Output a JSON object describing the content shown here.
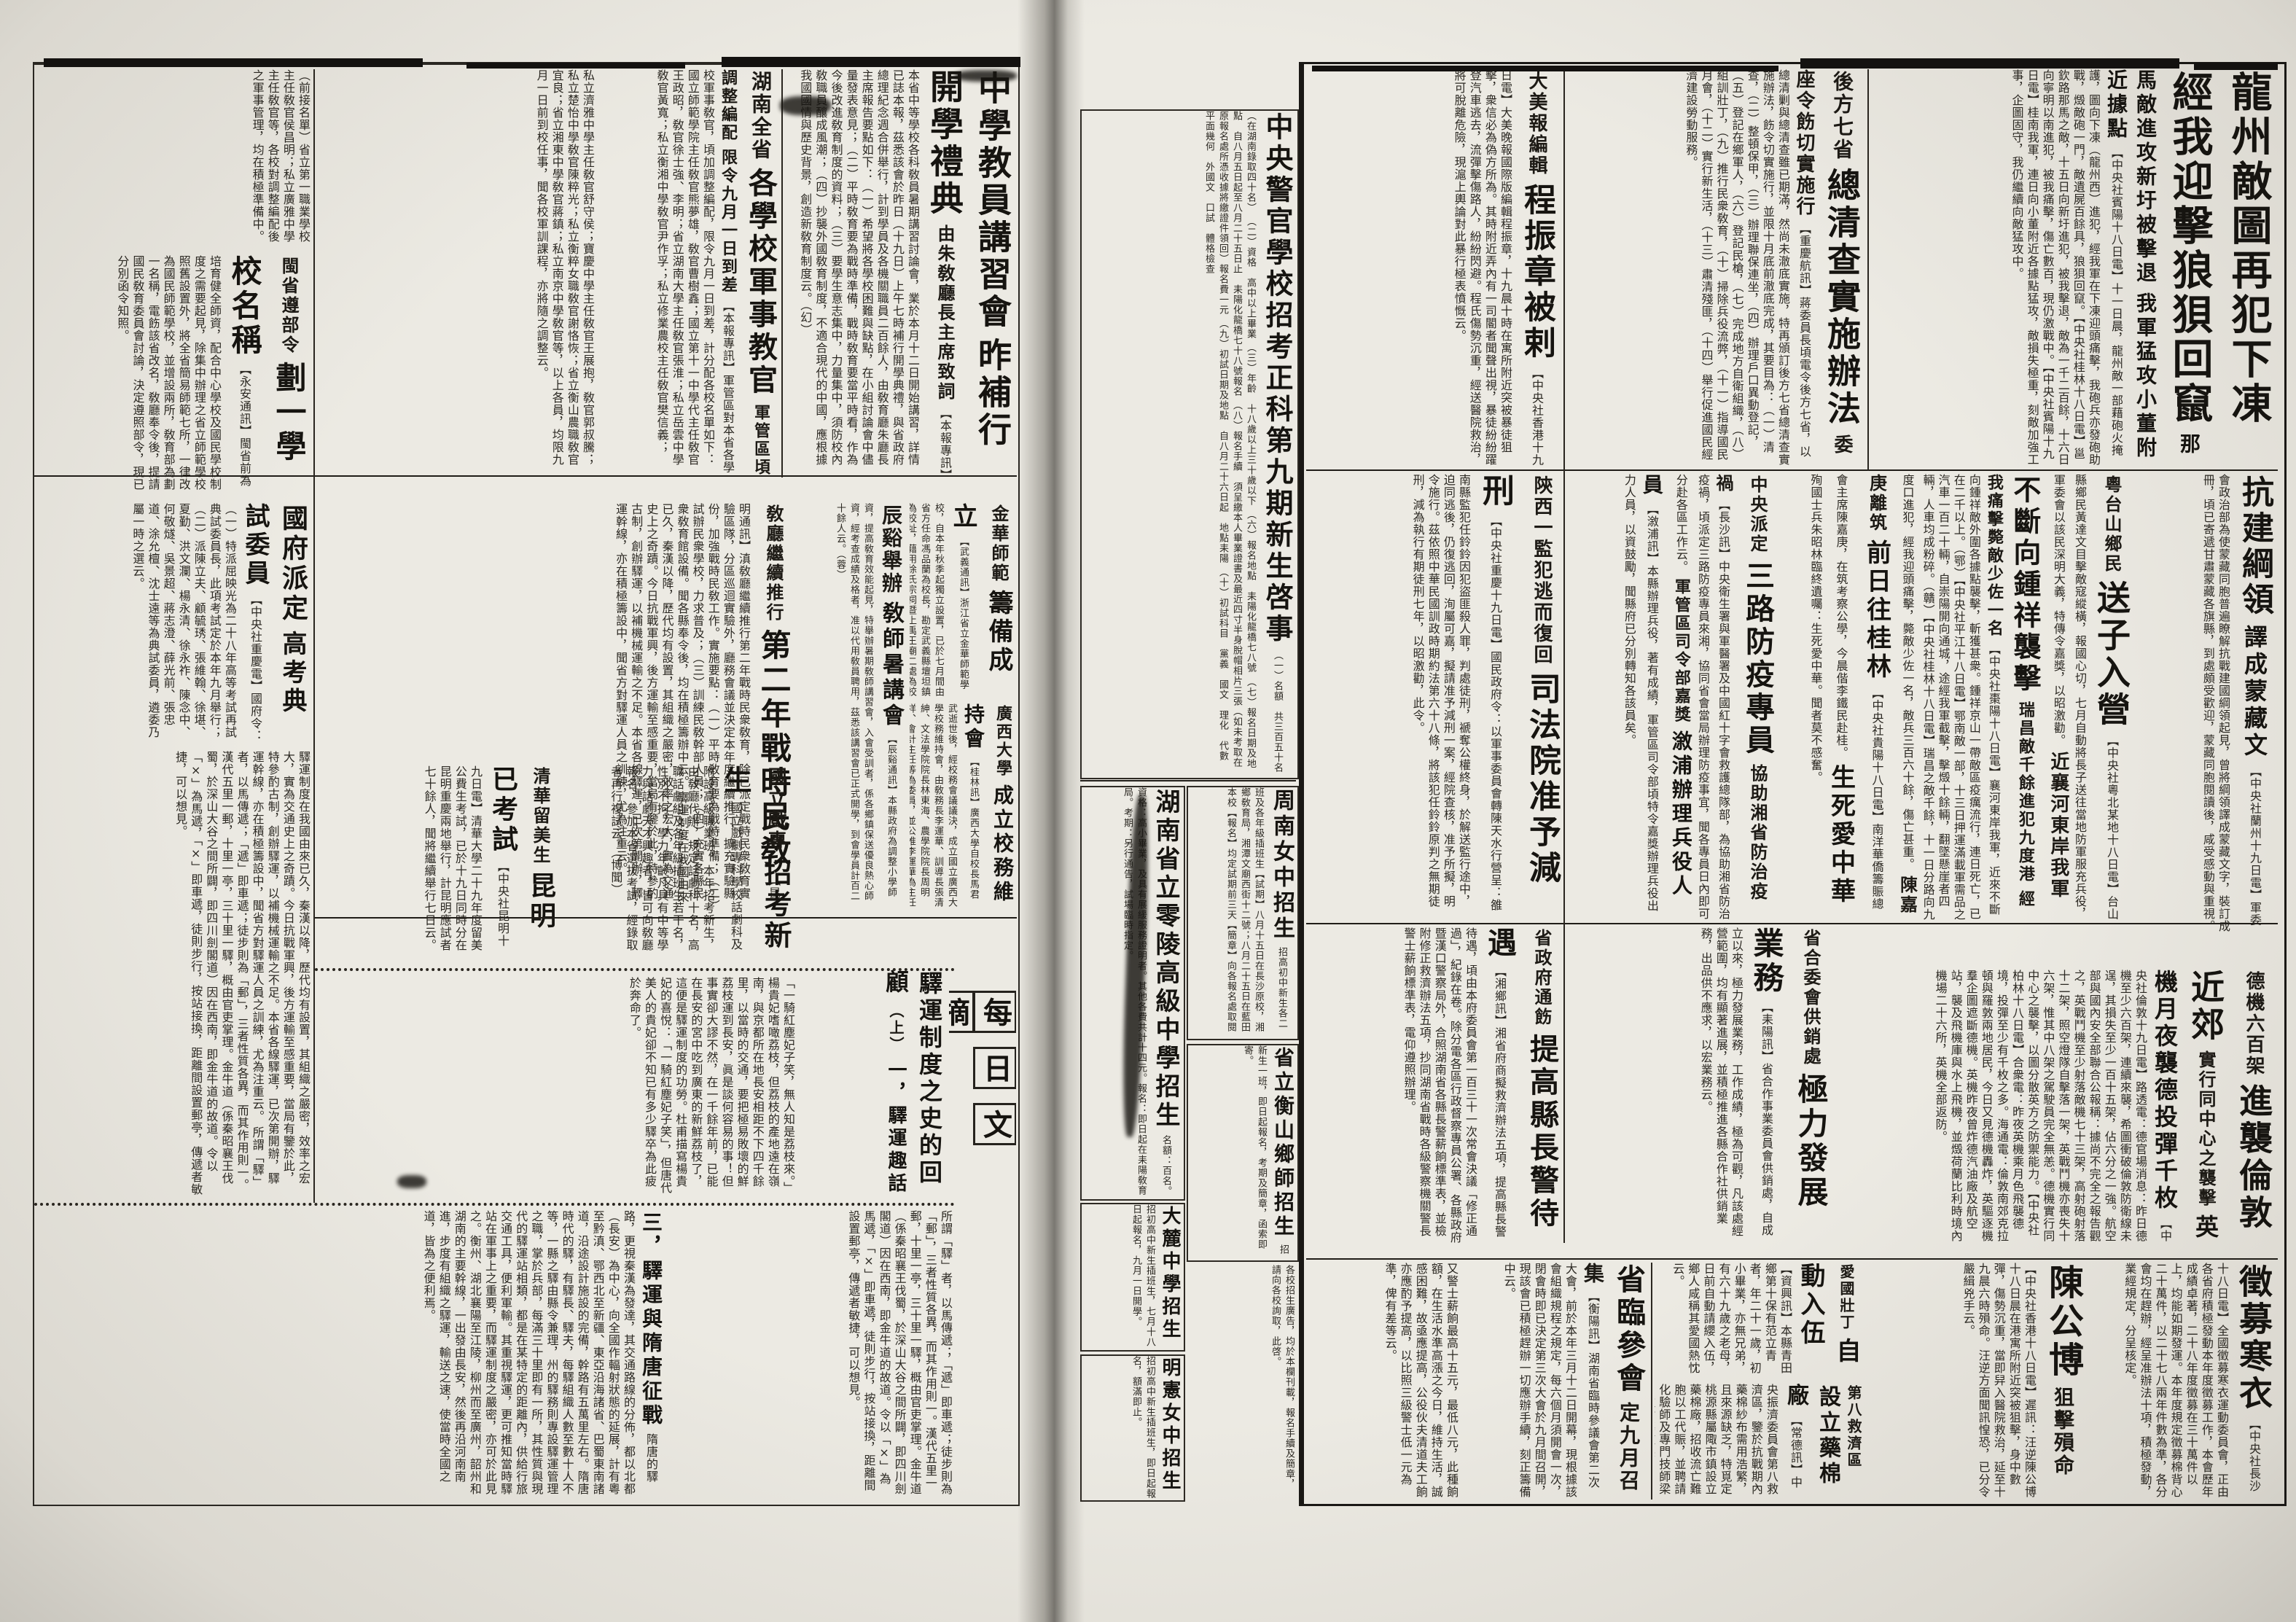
{
  "articles": {
    "longzhou": {
      "h1": "龍州敵圖再犯下凍",
      "h2": "經我迎擊狼狽回竄",
      "s1": "那馬敵進攻新圩被擊退",
      "s2": "我軍猛攻小董附近據點",
      "body": "【中央社賓陽十八日電】十一日晨，龍州敵一部藉砲火掩護，圖向下凍（龍州西）進犯，經我軍在下凍迎頭痛擊，我砲兵亦發砲助戰，燬敵砲一門，敵遺屍百餘具，狼狽回竄。【中央社桂林十八日電】邕欽路那馬之敵，十五日向新圩進犯，被我擊退，敵為一千二百餘，十六日向寧明以南進犯，被我痛擊，傷亡數百，現仍激戰中。【中央社賓陽十九日電】桂南我軍，連日向小董附近各據點猛攻，敵損失極重，刻敵加強工事，企圖固守，我仍繼續向敵猛攻中。"
    },
    "qingcha": {
      "k": "後方七省",
      "h": "總清查實施辦法",
      "s": "委座令飭切實施行",
      "body": "【重慶航訊】蔣委員長頃電令後方七省，以總清剿與總清查雖已期滿，然尚未澈底實施，特再頒訂後方七省總清查實施辦法，飭令切實施行，並限十月底前澈底完成，其要目為：（一）清查，（二）整頓保甲，（三）辦理聯保連坐，（四）辦理戶口異動登記，（五）登記在鄉軍人，（六）登記民槍，（七）完成地方自衛組織，（八）組訓壯丁，（九）推行民衆敎育，（十）掃除兵役流弊，（十一）指導國民月會，（十二）實行新生活，（十三）肅清殘匪，（十四）舉行促進國民經濟建設勞動服務。"
    },
    "chengzhenzhang": {
      "k": "大美報編輯",
      "h": "程振章被剌",
      "body": "【中央社香港十九日電】大美晚報國際版編輯程振章，十九晨十時在寓所附近突被暴徒狙擊，衆信必為偽方所為。其時附近弄內有一司閽者聞聲出視，暴徒紛紛躍登汽車逃去，流彈擊傷路人，紛紛閃避。程氏傷勢沉重，經送醫院救治，將可脫離危險，現滬上輿論對此暴行極表憤慨云。"
    },
    "sifa": {
      "k": "陝西一監犯逃而復回",
      "h": "司法院准予減刑",
      "body": "【中央社重慶十九日電】國民政府令：以軍事委員會轉陳天水行營呈：雒南縣監犯任鈴鈴因犯盜匪殺人罪，判處徒刑，褫奪公權終身，於解送監行途中，迫同逃後，仍復逃回，洵屬可嘉，擬請准予減刑一案，經院查核，准予所擬，明令施行。茲依照中華民國訓政時期約法第六十八條，將該犯任鈴鈴原判之無期徒刑，減為執行有期徒刑七年，以昭激勸，此令。"
    },
    "fangyi": {
      "k": "中央派定",
      "h": "三路防疫專員",
      "s": "協助湘省防治疫禍",
      "body": "【長沙訊】中央衛生署與軍醫署及中國紅十字會救護總隊部，為協助湘省防治疫禍，頃派定三路防疫專員來湘，協同省會當局辦理防疫事宜，聞各專員日內即可分赴各區工作云。",
      "k2": "軍管區司令部嘉獎",
      "h2": "漵浦辦理兵役人員",
      "body2": "【漵浦訊】本縣辦理兵役，著有成績，軍管區司令部頃特令嘉獎辦理兵役出力人員，以資鼓勵，聞縣府已分別轉知各該員矣。"
    },
    "kangjian": {
      "h": "抗建綱領",
      "s": "譯成蒙藏文",
      "body": "【中央社蘭州十九日電】軍委會政治部為使蒙藏同胞普遍瞭解抗戰建國綱領起見，曾將綱領譯成蒙藏文字，裝訂成冊，頃已寄遞甘肅蒙藏各旗縣，到處頗受歡迎，蒙藏同胞閱讀後，咸受感動與重視。"
    },
    "bmid": {
      "songzi_k": "粵台山鄉民",
      "songzi_h": "送子入營",
      "songzi_b": "【中央社粵北某地十八日電】台山縣鄉民黃達文目擊敵寇縱橫，報國心切，七月自動將長子送往當地防軍服充兵役，軍委會以該民深明大義，特傳令嘉獎，以昭激勸。",
      "zx_k": "近襄河東岸我軍",
      "zx_h": "不斷向鍾祥襲擊",
      "zx_s1": "瑞昌敵千餘進犯九度港",
      "zx_s2": "經我痛擊斃敵少佐一名",
      "zx_b": "【中央社棗陽十八日電】襄河東岸我軍，近來不斷向鍾祥敵外圍各據點襲擊，斬獲甚衆。鍾祥京山一帶敵區疫癘流行，連日死亡，已在二千以上。（鄂）【中央社平江十八日電】鄂南敵一部，十三日押運滿載軍需品之汽車一百二十輛，自崇陽開向通城，途經我軍截擊，擊燬十餘輛，翻墜懸崖者四輛，人車均成粉碎。（贛）【中央社桂林十八日電】瑞昌之敵千餘，十一日分路向九度口進犯，經我迎頭痛擊，斃敵少佐一名，敵兵三百六十餘，傷亡甚重。",
      "cjg_k": "陳嘉庚離筑",
      "cjg_h": "前日往桂林",
      "cjg_b": "【中央社貴陽十八日電】南洋華僑籌賑總會主席陳嘉庚，在筑考察公學，今晨偕李鐵民赴桂。",
      "ssa_h": "生死愛中華",
      "ssa_b": "殉國士兵朱昭林臨終遺囑：生死愛中華。聞者莫不感奮。"
    },
    "dejl": {
      "k": "德機六百架",
      "h": "進襲倫敦近郊",
      "s": "實行同中心之襲擊",
      "h2": "英機月夜襲德投彈千枚",
      "body": "【中央社倫敦十九日電】路透電：德官場消息：昨日德機至少六百架，連續來襲，希圖衝破倫敦防衛線未逞，其損失至少一百十五架，佔六分之一強。航空部與國內安全部聯合公報稱：據尚不完全之報告觀之，英戰鬥機至少射落敵機七十三架，高射砲射落十二架，照空燈隊自擊落一架，英戰鬥機亦喪失十六架，惟其中八架之駕駛員完全無恙。德機實行同中心之襲擊，以圖分散英方之防禦能力。【中央社柏林十八日電】合衆電：昨夜英機乘月色飛襲德境，投彈至少有千枚之多。海通電：倫敦南郊克拉頓與羅敦兩地居民，今日又見德機轟炸，英驅逐機羣企圖遮斷德機。英機昨夜曾炸德汽油廠及航空站，襲及飛機庫與水上飛機，並燬荷蘭比利時境內機場二十六所，英機全部返防。"
    },
    "gongxiao": {
      "k": "省合委會供銷處",
      "h": "極力發展業務",
      "body": "【耒陽訊】省合作事業委員會供銷處，自成立以來，極力發展業務，工作成績，極為可觀，凡該處經營範圍，均有顯著進展，並積極推進各縣合作社供銷業務，出品供不應求，以宏業務云。"
    },
    "tigao": {
      "k": "省政府通飭",
      "h": "提高縣長警待遇",
      "body": "【湘鄉訊】湘省府商擬救濟辦法五項，提高縣長警待遇，頃由本府委員會第一百三十一次常會決議「修正通過」，紀錄在卷。除分電各區行政督察專員公署、各縣政府暨漢口警察局外，合照湖南省各縣長警薪餉標準表，並檢附修正救濟辦法五項，抄同湖南省戰時各級警察機關警長警士薪餉標準表，電仰遵照辦理。",
      "body2": "又警士薪餉最高十五元，最低八元，此種餉額，在生活水準高漲之今日，維持生活，誠感困難，故亟應提高，公役伙夫清道夫工餉亦應酌予提高，以比照三級警士低一元為準，俾有差等云。"
    },
    "zhengmu": {
      "h": "徵募寒衣",
      "body": "【中央社長沙十八日電】全國徵募寒衣運動委員會，正由各省府積極發動本年度徵募工作，本會歷年成績卓著，二十八年度徵募在三十萬件以上，均能如期發運。本年度規定徵募棉背心二十萬件，以二十七八兩年件數為準，各分會均在趕辦，經呈准辦法十項，積極發動，業經規定，分呈核定。"
    },
    "chengongbo": {
      "h": "陳公博",
      "s": "狙擊殞命",
      "body": "【中央社香港十八日電】遲訊：汪逆陳公博十八日晨在港寓所附近突被狙擊，身中數彈，傷勢沉重，當即舁入醫院救治，延至十九晨六時殞命。汪逆方面聞訊惶恐，已分令嚴緝兇手云。"
    },
    "aiguo": {
      "k": "愛國壯丁",
      "h": "自動入伍",
      "body": "【資興訊】本縣青田鄉第十保有范立青者，年二十一歲，初小畢業，亦無兄弟，有六十九歲之老母，日前自動請纓入伍，鄉人咸稱其愛國熱忱云。"
    },
    "diba": {
      "k": "第八救濟區",
      "h": "設立藥棉廠",
      "body": "【常德訊】中央振濟委員會第八救濟區，鑒於抗戰期內藥棉紗布需用浩繁，且來源缺乏，特覓定桃源縣屬陬市鎮設立藥棉廠，招收流亡難胞以工代賑，並聘請化驗師及專門技師梁剛柱指導監製，出品精良，定價低廉，各大藥房衛生機關各部隊醫院，均紛紛前往該廠採購云。（益世社）"
    },
    "shenglincan": {
      "k": "省臨參會",
      "h": "定九月召集",
      "body": "【衡陽訊】湖南省臨時參議會第二次大會，前於本年三月十二日開幕，現根據該會組織規程之規定，每六個月須開會一次，閉會時即已決定第三次大會於九月間召開，現該會已積極趕辦一切應辦手續，刻正籌備中云。"
    },
    "jiangxihui": {
      "h1": "中學教員講習會",
      "h2": "昨補行開學禮典",
      "s": "由朱敎廳長主席致詞",
      "body": "【本報專訊】本省中等學校各科敎員暑期講習討論會，業於本月十二日開始講習，詳情已誌本報，茲悉該會於昨日（十九日）上午七時補行開學典禮，與省政府總理紀念週合併舉行，計到學員及各機關職員二百餘人，由敎育廳朱廳長主席報告要點如下：（一）希望將各學校困難與缺點，在小組討論會中儘量發表意見；（二）平時敎育要為戰時準備，戰時敎育要當平時看，作為今後改進敎育制度的資料；（三）要學生意志集中，力量集中，須防校內敎職員釀成風潮；（四）抄襲外國敎育制度，不適合現代的中國，應根據我國國情與歷史背景，創造新敎育制度云。（幻）"
    },
    "junjiao": {
      "k": "湖南全省",
      "h": "各學校軍事教官",
      "s1": "軍管區頃調整編配",
      "s2": "限令九月一日到差",
      "body": "【本報專訊】軍管區對本省各學校軍事敎官，頃加調整編配，限令九月一日到差，計分配各校名單如下：國立師範學院主任敎官熊夢雄，敎官曹樹鑫；國立第十一中學代主任敎官王政昭，敎官徐士強、李明；省立湖南大學主任敎官張淮；私立岳雲中學敎官黃寬；私立衡湘中學敎官尹作孚；私立修業農校主任敎官樊信義；",
      "body2": "私立濟雅中學主任敎官舒守侯；寶慶中學主任敎官王展抱，敎官郭叔騰；私立楚怡中學敎官陳粹光；私立衡粹女職敎官謝恪恢；省立衡山農職敎官宜良；省立湘東中學敎官蔣鎮；私立南京中學敎官等，以上各員，均限九月一日前到校任事，聞各校軍訓課程，亦將隨之調整云。",
      "body3": "（前接名單）省立第一職業學校主任敎官侯昌明；私立廣雅中學主任敎官等，各校對調整編配後之軍事管理，均在積極準備中。"
    },
    "minbu": {
      "k": "閩省遵部令",
      "h": "劃一學校名稱",
      "body": "【永安通訊】閩省前為培育健全師資，配合中心學校及國民學校制度之需要起見，除集中辦理之省立師範學校照舊設置外，將全省簡易師範七所，一律改為國民師範學校，並增設兩所，敎育部為劃一名稱，電飭該省改名，敎廳奉令後，提請國民敎育委員會討論，決定遵照部令，現已分別函令知照。"
    },
    "gaokao": {
      "k": "國府派定",
      "h": "高考典試委員",
      "body": "【中央社重慶電】國府令：（一）特派屈映光為二十八年高等考試再試典試委員長，此項考試定於本年九月舉行；（二）派陳立夫、顧毓琇、張維翰、徐堪、夏勤、洪文瀾、楊永清、徐永祚、陳念中、何敬燧、吳景超、蔣志澄、薛光前、張忠道、涂允檀、沈士遠等為典試委員，遴委乃屬一時之選云。"
    },
    "minjiao": {
      "k": "敎廳繼續推行",
      "h": "第二年戰時民敎",
      "body": "【昆明通訊】滇敎廳繼續推行第二年戰時民衆敎育，除已派定戰時民衆敎育實驗區隊，分區巡迴實驗外，廳務會議並決定本年度繼續推行，擴充實驗縣份，加強戰時民敎工作。實施要點：（一）平時敎育要為戰時準備；（二）試辦民衆學校，力求普及；（三）訓練民敎幹部人員；（四）充實各縣民衆敎育館設備。聞各縣奉令後，均在積極籌辦中云。"
    },
    "chenxi": {
      "k": "辰谿舉辦",
      "h": "敎師暑講會",
      "body": "【辰谿通訊】本縣政府為調整小學師資，提高敎育效能起見，特舉辦暑期敎師講習會，入會受訓者，係各鄉鎮保送優良熱心師資，經考查成績及格者，准以代用敎員聘用，茲悉該講習會已正式開學，到會學員計百二十餘人云。（蓉）"
    },
    "jinhua": {
      "k": "金華師範",
      "h": "籌備成立",
      "body": "【武義通訊】浙江省立金華師範學校，自本年秋季起獨立設置，已於七月間由省方任命馮品蘭為校長，勘定武義縣壇坦鎮為校址，藉用徐氏宗祠暨上禹王廟二處為校舍，興工修建，着手佈置，以期如期開學云。"
    },
    "guangxi": {
      "k": "廣西大學",
      "h": "成立校務維持會",
      "body": "【桂林訊】廣西大學自校長馬君武逝世後，經校務會議議決，成立國立廣西大學校務維持會，由敎務長李運華、訓導長張清紳、文法學院院長林東海、農學院院長周明祥、會計主任等為委員，並公推李運華為主任委員，在繼任校長未定以前，由該會負責，暫行維持云。（博聞）"
    },
    "guoxi": {
      "k": "國立戲專",
      "h": "招考新生",
      "body": "國立戲劇專科學校話劇科及附設高級職業班，本年招考新生，由敎廳代辦，規定話劇科十名，高職話劇組及各年級插班生若干名，性別不拘，學力年齡凡具有中等學力與話劇天才興趣者，皆可向敎廳報名，參加本省選拔考試，經錄取者再行複試云。（博聞）"
    },
    "qinghua": {
      "k": "清華留美生",
      "h": "昆明已考試",
      "body": "【中央社昆明十九日電】清華大學二十九年度留美公費生考試，已於十九日同時分在昆明重慶兩地舉行，計昆明應試者七十餘人，聞將繼續舉行七日云。"
    }
  },
  "digest": {
    "box_chars": [
      "每",
      "日",
      "文",
      "摘"
    ],
    "title": "驛運制度之史的回顧",
    "part": "（上）",
    "sec1": "一，驛運趣話",
    "sec3": "三，驛運與隋唐征戰",
    "body1": "「一騎紅塵妃子笑，無人知是荔枝來。」楊貴妃嗜噉荔枝，但荔枝的產地遠在嶺南，與京都所在地長安相距不下四千餘里，以當時的交通，要把極易敗壞的鮮荔枝運到長安，眞是談何容易的事！但事實卻大謬不然，在一千餘年前，已能在長安的宮中吃到廣東的新鮮荔枝了，這便是驛運制度的功勞。杜甫描寫楊貴妃的喜悅：「一騎紅塵妃子笑」，但唐代美人的貴妃卻不知已有多少驛卒為此疲於奔命了。",
    "body2": "所謂「驛」者，以馬傳遞；「遞」即車遞；徒步則為「郵」，三者性質各異，而其作用則一。漢代五里一郵，十里一亭，三十里一驛，概由官吏掌理。金牛道（係秦昭襄王伐蜀，於深山大谷之間所闢，即四川劍閣道）因在西南，即金牛道的故道。令以「×」為馬遞，「×」即車遞，徒則步行，按站接換，距離間設置郵亭，傳遞者敏捷，可以想見。",
    "body3": "隋唐的驛路，更視秦漢為發達，其交通路線的分佈，都以北都（長安）為中心，向全國作輻射狀態的延展，計有粵至黔滇、鄂西北至新疆、東亞沿海諸省、巴蜀東南諸道，沿途設計施設的完備，幹路有五萬里左右。隋唐時代的驛，有驛長、驛夫，每驛組織人數至數十人不等，一縣之驛由縣令兼理，州的驛務則專設驛運管理之職，掌於兵部，每滿三十里即有一所，其性質與現代的驛運站相類，都是在某特定的距離內，供給行旅交通工具，便利軍輸。其重視驛運，更可推知當時驛站在軍事上之重要，而驛運制度之嚴密，亦可於此見之。衡州、湖北襄陽至江陵，柳州而至廣州，韶州和湖南的主要幹線，一出發由長安，然後再沿河南南進，步度有組織之驛運，輸送之速，使當時全國之道，皆為之便利焉。"
  },
  "center": {
    "police": {
      "title": "中央警官學校招考正科第九期新生啓事",
      "items": [
        "（一）名額　共三百五十名（在湖南錄取四十名）",
        "（二）資格　高中以上畢業",
        "（三）年齡　十八歲以上三十歲以下",
        "（六）報名地點　耒陽化龍橋七八號",
        "（七）報名日期及地點　自八月五日起至八月二十五日止　耒陽化龍橋七十八號報名",
        "（八）報名手續　須呈繳本人畢業證書及最近四寸半身脫帽相片三張（如未考取在原報名處所憑收據將繳證件領回）報名費一元",
        "（九）初試日期及地點　自八月二十六日起　地點耒陽",
        "（十）初試科目　黨義　國文　理化　代數　平面幾何　外國文　口試　體格檢查"
      ]
    },
    "lingling": {
      "title": "湖南省立零陵高級中學招生",
      "body": "名額：百名。資格：高小畢業，及具有展緩服務證明者。其他各費共計十四元。報名：即日起在耒陽敎育局。考期：另行通告，試場臨時指定。"
    },
    "zhounan": {
      "title": "周南女中招生",
      "body": "招高初中新生各二班及各年級插班生【試期】八月十五日在長沙原校，湘鄉敎育局，湘潭文廟西街十二號；八月二十五日在藍田本校【報名】均定試期前三天【簡章】向各報名處取閱"
    },
    "hengshan": {
      "title": "省立衡山鄉師招生",
      "body": "招新生一班，即日起報名，考期及簡章，函索即寄。"
    },
    "dalu": {
      "title": "大麓中學招生",
      "body": "招初高中新生插班生，七月十八日起報名，九月一日開學。"
    },
    "mingxian": {
      "title": "明憲女中招生",
      "body": "招初高中新生插班生，即日起報名，額滿即止。"
    },
    "note": "各校招生廣告，均於本欄刊載，報名手續及簡章，請向各校詢取，此啓。"
  },
  "filler": {
    "col_text": "驛運制度在我國由來已久，秦漢以降，歷代均有設置，其組織之嚴密，效率之宏大，實為交通史上之奇蹟。今日抗戰軍興，後方運輸至感重要，當局有鑒於此，特參酌古制，創辦驛運，以補機械運輸之不足。本省各線驛運，已次第開辦，驛運幹線，亦在積極籌設中，聞省方對驛運人員之訓練，尤為注重云。"
  }
}
